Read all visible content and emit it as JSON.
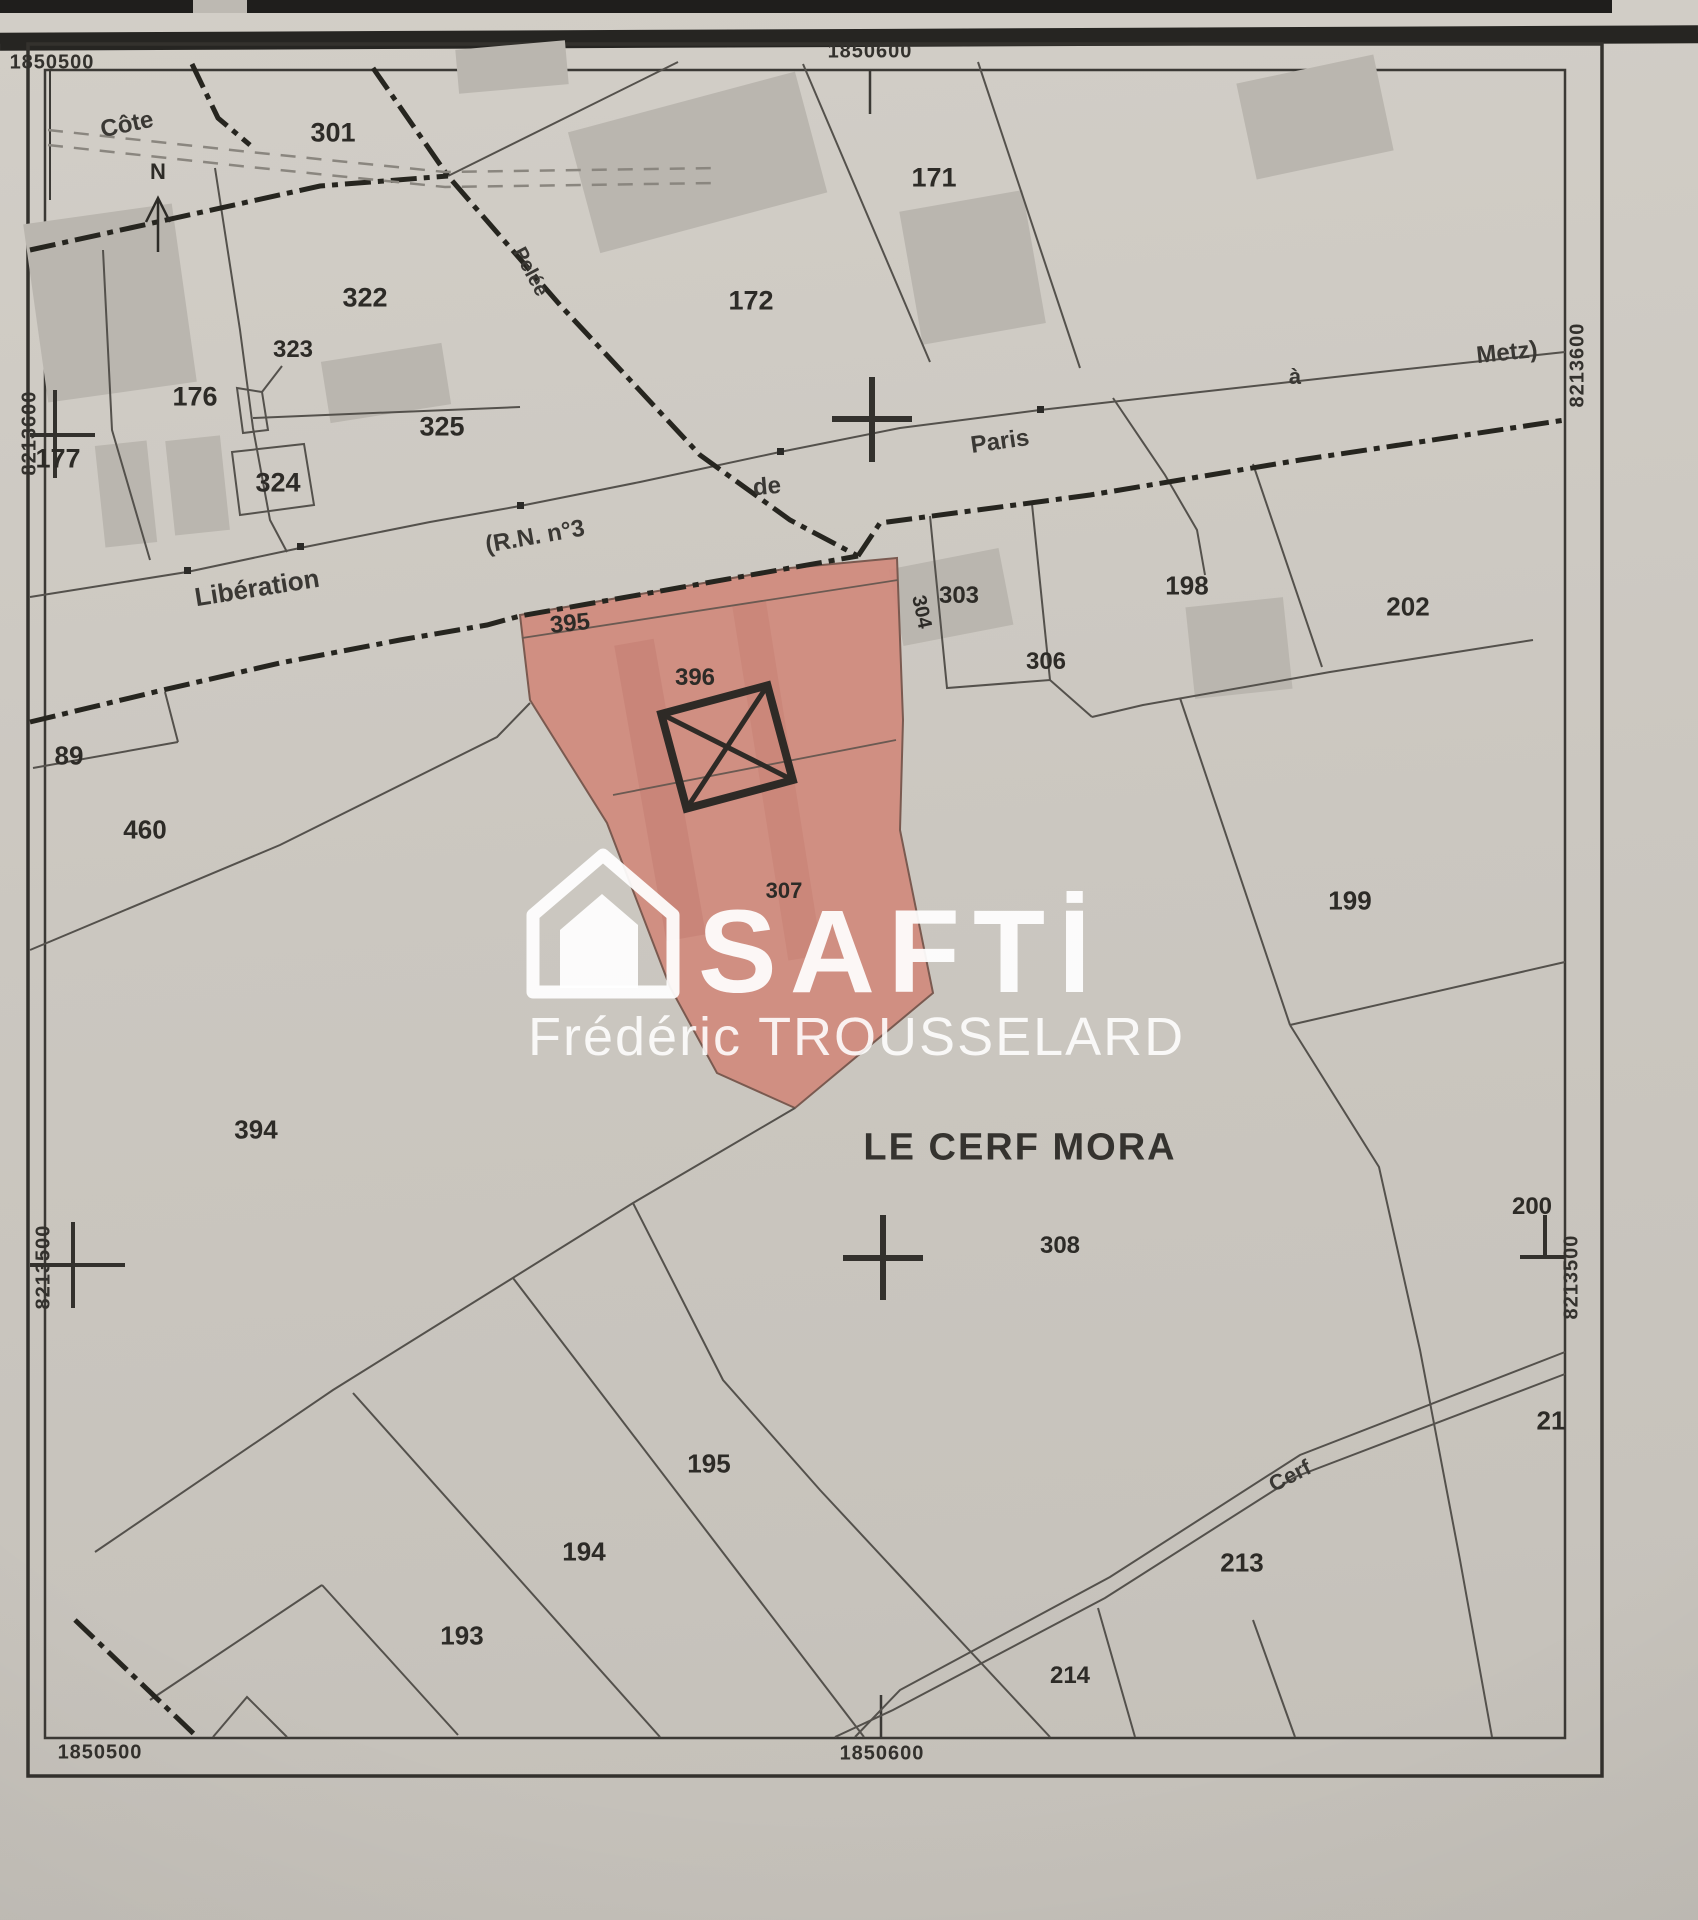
{
  "map": {
    "type": "cadastral-plan",
    "place_name": "LE CERF MORA",
    "north_label": "N",
    "watermark": {
      "brand": "SAFTİ",
      "agent": "Frédéric TROUSSELARD"
    },
    "highlight": {
      "color": "#d08a7d",
      "highlighted_parcels": [
        "395",
        "396",
        "307"
      ]
    },
    "coordinates": [
      {
        "text": "1850500",
        "x": 52,
        "y": 63,
        "rot": 0
      },
      {
        "text": "1850600",
        "x": 870,
        "y": 52,
        "rot": 0
      },
      {
        "text": "1850500",
        "x": 100,
        "y": 1753,
        "rot": 0
      },
      {
        "text": "1850600",
        "x": 882,
        "y": 1754,
        "rot": 0
      },
      {
        "text": "8213600",
        "x": 30,
        "y": 433,
        "rot": -90
      },
      {
        "text": "8213500",
        "x": 44,
        "y": 1267,
        "rot": -90
      },
      {
        "text": "8213600",
        "x": 1578,
        "y": 365,
        "rot": -90
      },
      {
        "text": "8213500",
        "x": 1572,
        "y": 1277,
        "rot": -90
      }
    ],
    "parcels": [
      {
        "id": "301",
        "x": 333,
        "y": 133,
        "fs": 27,
        "rot": 0
      },
      {
        "id": "322",
        "x": 365,
        "y": 298,
        "fs": 27,
        "rot": 0
      },
      {
        "id": "323",
        "x": 293,
        "y": 350,
        "fs": 24,
        "rot": 0
      },
      {
        "id": "176",
        "x": 195,
        "y": 397,
        "fs": 27,
        "rot": 0
      },
      {
        "id": "177",
        "x": 58,
        "y": 459,
        "fs": 27,
        "rot": 0
      },
      {
        "id": "325",
        "x": 442,
        "y": 427,
        "fs": 27,
        "rot": 0
      },
      {
        "id": "324",
        "x": 278,
        "y": 483,
        "fs": 27,
        "rot": 0
      },
      {
        "id": "172",
        "x": 751,
        "y": 301,
        "fs": 27,
        "rot": 0
      },
      {
        "id": "171",
        "x": 934,
        "y": 178,
        "fs": 27,
        "rot": 0
      },
      {
        "id": "303",
        "x": 959,
        "y": 596,
        "fs": 24,
        "rot": 0
      },
      {
        "id": "304",
        "x": 921,
        "y": 612,
        "fs": 20,
        "rot": 78
      },
      {
        "id": "306",
        "x": 1046,
        "y": 662,
        "fs": 24,
        "rot": 0
      },
      {
        "id": "198",
        "x": 1187,
        "y": 586,
        "fs": 26,
        "rot": 0
      },
      {
        "id": "202",
        "x": 1408,
        "y": 607,
        "fs": 26,
        "rot": 0
      },
      {
        "id": "199",
        "x": 1350,
        "y": 901,
        "fs": 26,
        "rot": 0
      },
      {
        "id": "200",
        "x": 1532,
        "y": 1207,
        "fs": 24,
        "rot": 0
      },
      {
        "id": "395",
        "x": 570,
        "y": 624,
        "fs": 24,
        "rot": -6
      },
      {
        "id": "396",
        "x": 695,
        "y": 678,
        "fs": 24,
        "rot": 0
      },
      {
        "id": "307",
        "x": 784,
        "y": 891,
        "fs": 22,
        "rot": 0
      },
      {
        "id": "460",
        "x": 145,
        "y": 830,
        "fs": 26,
        "rot": 0
      },
      {
        "id": "89",
        "x": 69,
        "y": 756,
        "fs": 26,
        "rot": 0
      },
      {
        "id": "394",
        "x": 256,
        "y": 1130,
        "fs": 26,
        "rot": 0
      },
      {
        "id": "308",
        "x": 1060,
        "y": 1246,
        "fs": 24,
        "rot": 0
      },
      {
        "id": "195",
        "x": 709,
        "y": 1464,
        "fs": 26,
        "rot": 0
      },
      {
        "id": "194",
        "x": 584,
        "y": 1552,
        "fs": 26,
        "rot": 0
      },
      {
        "id": "193",
        "x": 462,
        "y": 1636,
        "fs": 26,
        "rot": 0
      },
      {
        "id": "214",
        "x": 1070,
        "y": 1676,
        "fs": 24,
        "rot": 0
      },
      {
        "id": "213",
        "x": 1242,
        "y": 1563,
        "fs": 26,
        "rot": 0
      },
      {
        "id": "21",
        "x": 1551,
        "y": 1421,
        "fs": 26,
        "rot": 0
      }
    ],
    "road_labels": [
      {
        "text": "Côte",
        "x": 127,
        "y": 125,
        "fs": 24,
        "rot": -12
      },
      {
        "text": "Pelée",
        "x": 530,
        "y": 272,
        "fs": 20,
        "rot": 62
      },
      {
        "text": "Libération",
        "x": 257,
        "y": 588,
        "fs": 26,
        "rot": -9
      },
      {
        "text": "(R.N. n°3",
        "x": 535,
        "y": 537,
        "fs": 24,
        "rot": -10
      },
      {
        "text": "de",
        "x": 767,
        "y": 487,
        "fs": 24,
        "rot": -5
      },
      {
        "text": "Paris",
        "x": 1000,
        "y": 442,
        "fs": 24,
        "rot": -8
      },
      {
        "text": "à",
        "x": 1295,
        "y": 377,
        "fs": 22,
        "rot": 0
      },
      {
        "text": "Metz)",
        "x": 1507,
        "y": 353,
        "fs": 24,
        "rot": -6
      },
      {
        "text": "Cerf",
        "x": 1290,
        "y": 1476,
        "fs": 22,
        "rot": -27
      }
    ]
  }
}
